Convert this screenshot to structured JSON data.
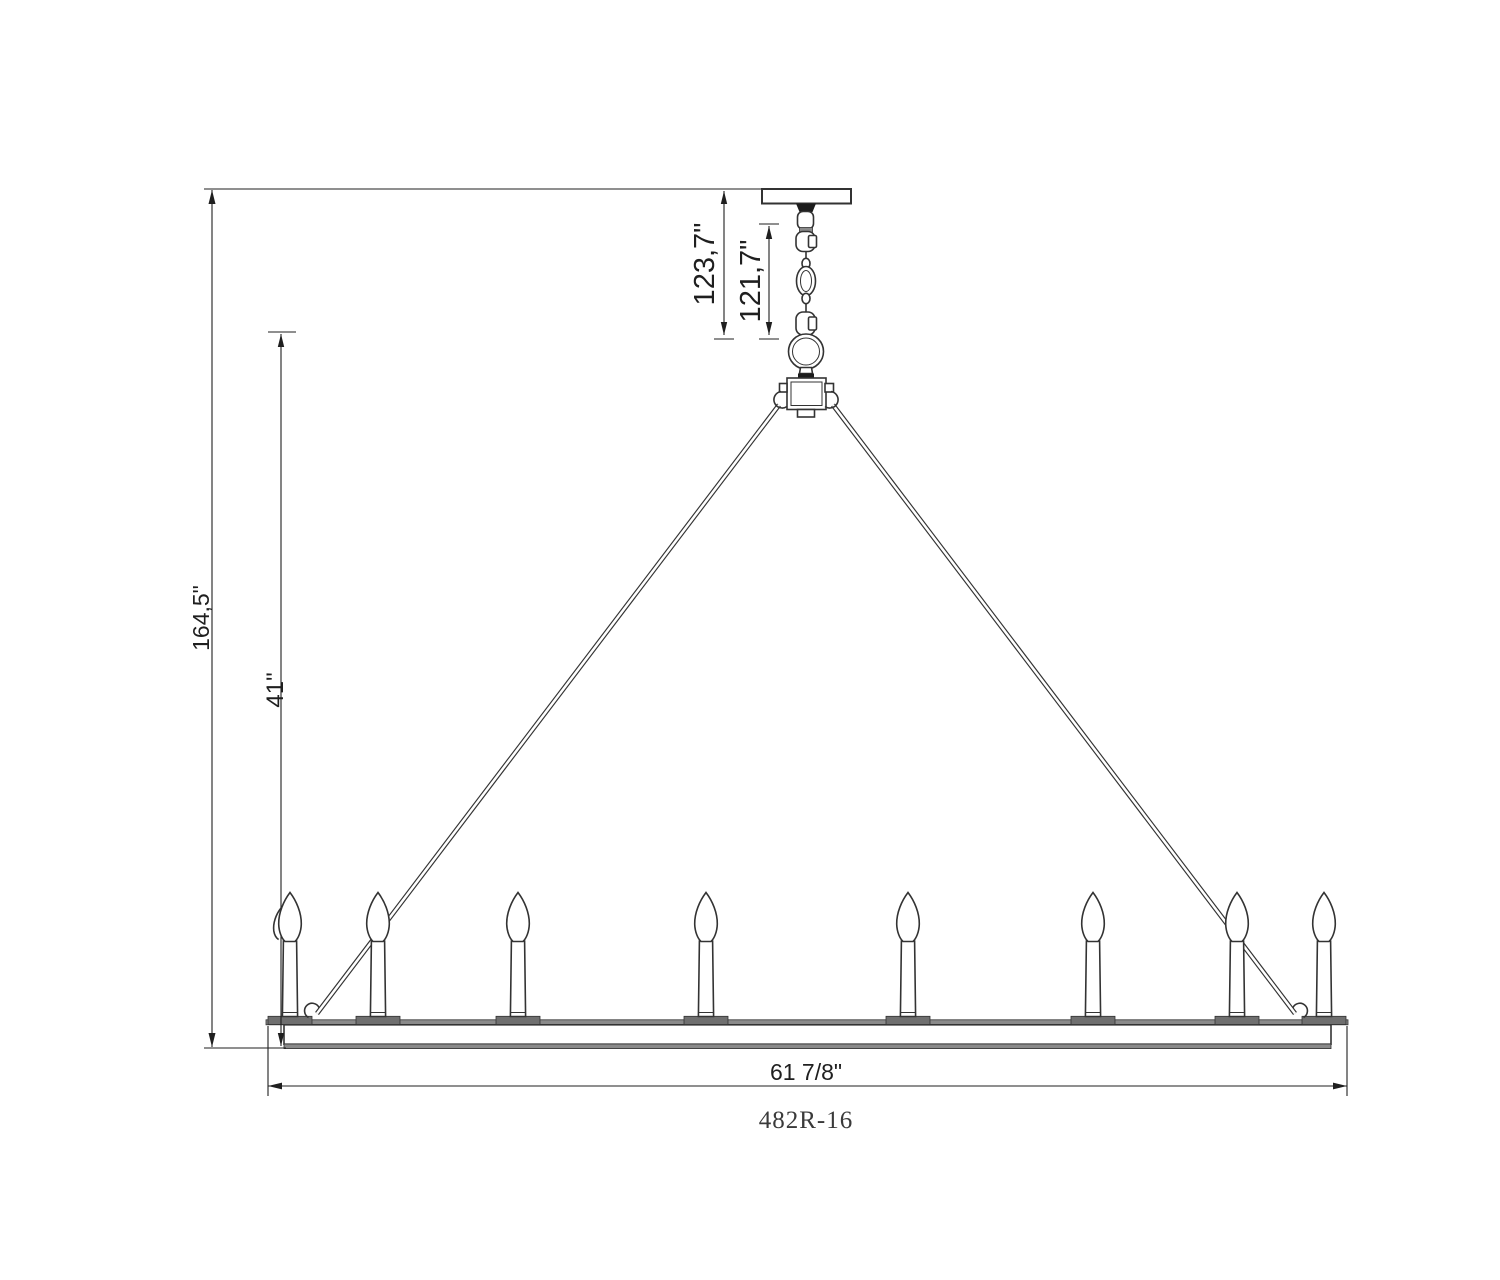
{
  "drawing": {
    "type": "chandelier-dimension-diagram",
    "product_code": "482R-16",
    "dimensions": {
      "overall_height": "164,5\"",
      "fixture_height": "41\"",
      "canopy_to_ring_top": "123,7\"",
      "chain_length": "121,7\"",
      "ring_width": "61 7/8\""
    },
    "candles": {
      "count_visible": 8,
      "centers_px": [
        290,
        378,
        518,
        706,
        908,
        1093,
        1237,
        1324
      ],
      "has_partial_back_candle": true
    },
    "colors": {
      "background": "#ffffff",
      "line": "#333333",
      "dimension": "#1f1f1f",
      "ink": "#1c1c1c",
      "metal_gray": "#8a8a8a",
      "dark_metal_gray": "#6f6f6f"
    }
  }
}
